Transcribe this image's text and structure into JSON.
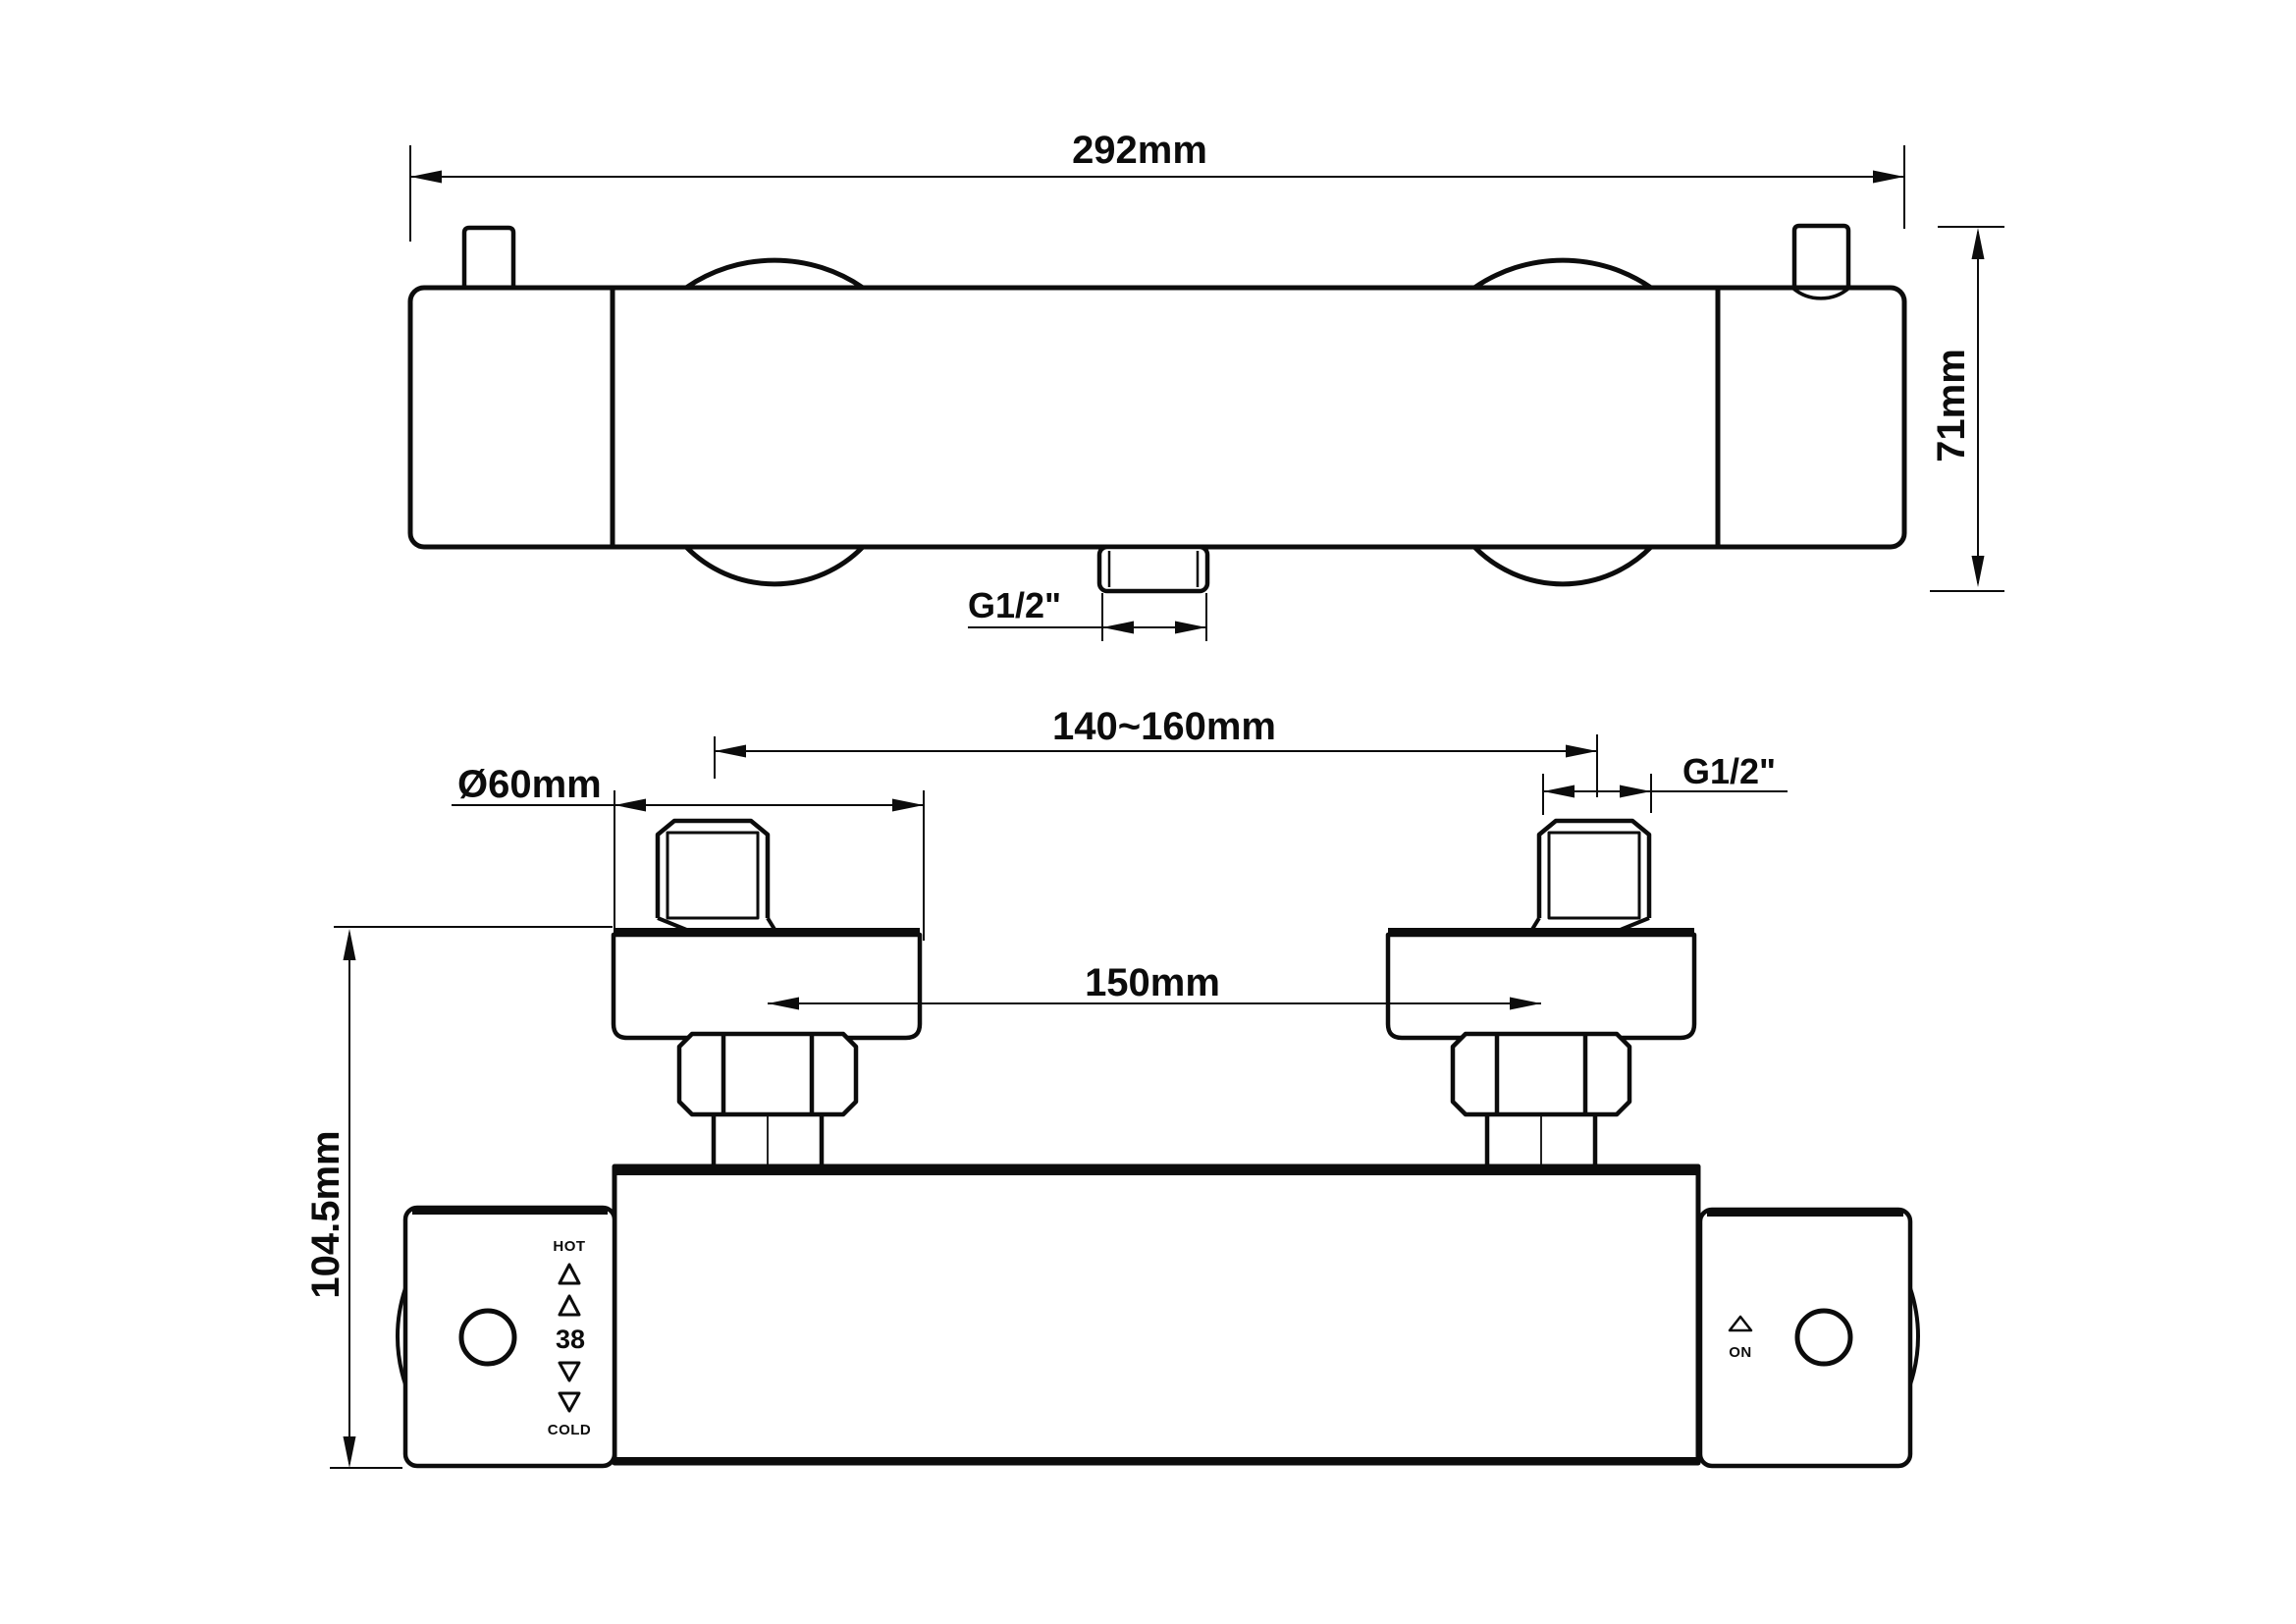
{
  "colors": {
    "ink": "#0c0c0c",
    "paper": "#ffffff"
  },
  "top_view": {
    "dim_overall_width": "292mm",
    "dim_height": "71mm",
    "dim_outlet_thread": "G1/2\""
  },
  "front_view": {
    "dim_inlet_spacing": "140~160mm",
    "dim_flange_diameter": "Ø60mm",
    "dim_inlet_thread": "G1/2\"",
    "dim_center_distance": "150mm",
    "dim_overall_height": "104.5mm",
    "temp_handle": {
      "hot": "HOT",
      "setpoint": "38",
      "cold": "COLD"
    },
    "flow_handle": {
      "on": "ON"
    }
  }
}
